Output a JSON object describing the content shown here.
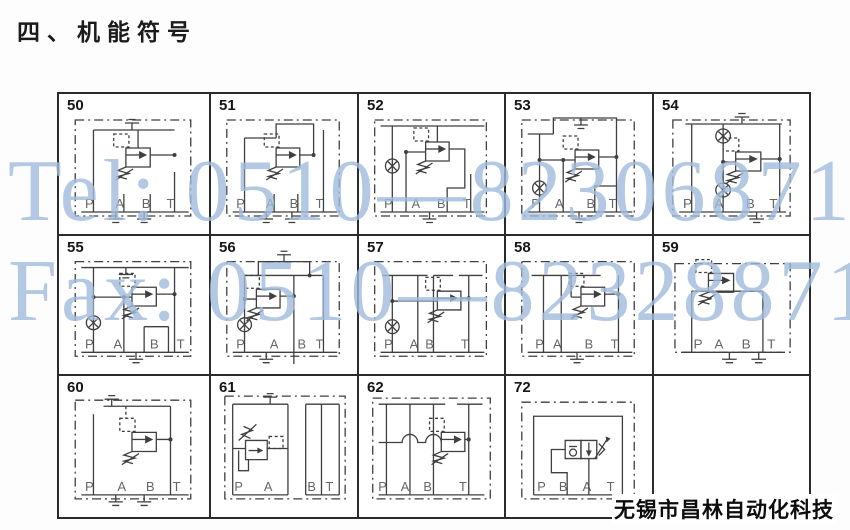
{
  "page": {
    "title": "四、机能符号",
    "footer": "无锡市昌林自动化科技"
  },
  "watermarks": {
    "line1": "Tel: 0510—82306871",
    "line2": "Fax: 0510—82328871",
    "color": "#a0bbdd"
  },
  "colors": {
    "line": "#3f3f3f",
    "grid_border": "#2b2b2b",
    "text": "#161616"
  },
  "cells": [
    {
      "number": "50",
      "ports": [
        "P",
        "A",
        "B",
        "T"
      ],
      "symbols": [
        "relief-valve",
        "vent-plug-top",
        "plugged-port",
        "plugged-port"
      ]
    },
    {
      "number": "51",
      "ports": [
        "P",
        "A",
        "B",
        "T"
      ],
      "symbols": [
        "relief-valve",
        "plugged-port",
        "plugged-port"
      ]
    },
    {
      "number": "52",
      "ports": [
        "P",
        "A",
        "B",
        "T"
      ],
      "symbols": [
        "relief-valve",
        "gauge-point",
        "plugged-port"
      ]
    },
    {
      "number": "53",
      "ports": [
        "P",
        "A",
        "B",
        "T"
      ],
      "symbols": [
        "relief-valve",
        "gauge-point",
        "vent-plug-top",
        "plugged-port"
      ]
    },
    {
      "number": "54",
      "ports": [
        "P",
        "A",
        "B",
        "T"
      ],
      "symbols": [
        "relief-valve",
        "gauge-point",
        "gauge-point",
        "vent-plug-top",
        "plugged-port"
      ]
    },
    {
      "number": "55",
      "ports": [
        "P",
        "A",
        "B",
        "T"
      ],
      "symbols": [
        "relief-valve",
        "gauge-point",
        "vent-plug-top",
        "plugged-port"
      ]
    },
    {
      "number": "56",
      "ports": [
        "P",
        "A",
        "B",
        "T"
      ],
      "symbols": [
        "relief-valve",
        "gauge-point",
        "vent-plug-top",
        "plugged-port"
      ]
    },
    {
      "number": "57",
      "ports": [
        "P",
        "A",
        "B",
        "T"
      ],
      "symbols": [
        "relief-valve",
        "gauge-point"
      ]
    },
    {
      "number": "58",
      "ports": [
        "P",
        "A",
        "B",
        "T"
      ],
      "symbols": [
        "relief-valve",
        "plugged-port"
      ]
    },
    {
      "number": "59",
      "ports": [
        "P",
        "A",
        "B",
        "T"
      ],
      "symbols": [
        "relief-valve",
        "plugged-port",
        "plugged-port"
      ]
    },
    {
      "number": "60",
      "ports": [
        "P",
        "A",
        "B",
        "T"
      ],
      "symbols": [
        "relief-valve",
        "vent-plug-top",
        "plugged-port",
        "plugged-port"
      ]
    },
    {
      "number": "61",
      "ports": [
        "P",
        "A",
        "B",
        "T"
      ],
      "symbols": [
        "reducing-valve",
        "vent-plug-top"
      ]
    },
    {
      "number": "62",
      "ports": [
        "P",
        "A",
        "B",
        "T"
      ],
      "symbols": [
        "relief-valve",
        "line-crossings"
      ]
    },
    {
      "number": "72",
      "ports": [
        "P",
        "B",
        "A",
        "T"
      ],
      "symbols": [
        "check-throttle-valve",
        "adjustable-arrow"
      ]
    },
    {
      "number": "",
      "ports": [],
      "symbols": []
    }
  ]
}
